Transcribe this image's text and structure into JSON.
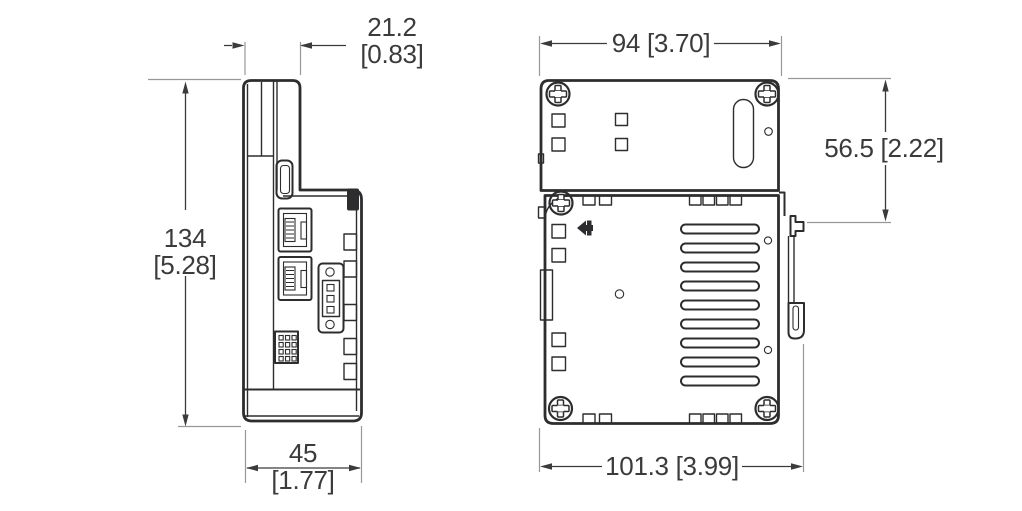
{
  "drawing": {
    "kind": "technical-dimension-drawing",
    "views": [
      "side-view",
      "front-view"
    ],
    "colors": {
      "outline": "#2d2d2f",
      "dimension_line": "#3b3b3d",
      "extension_line": "#98989b",
      "text": "#3b3b3d",
      "background": "#ffffff"
    }
  },
  "dimensions": {
    "side_top_width_mm": "21.2",
    "side_top_width_in": "[0.83]",
    "side_height_mm": "134",
    "side_height_in": "[5.28]",
    "side_bottom_width_mm": "45",
    "side_bottom_width_in": "[1.77]",
    "front_top_width": "94 [3.70]",
    "front_right_height": "56.5 [2.22]",
    "front_bottom_width": "101.3 [3.99]"
  }
}
